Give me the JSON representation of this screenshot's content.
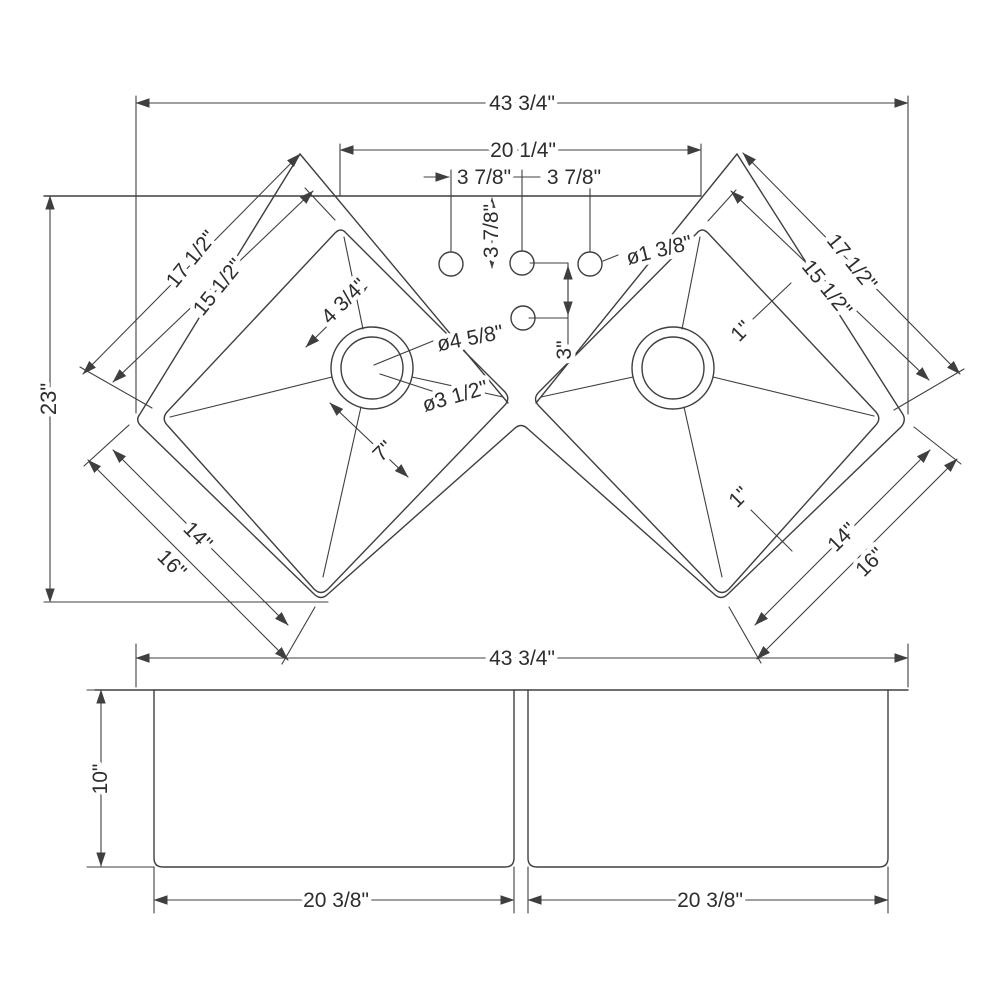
{
  "drawing_type": "corner double bowl sink dimension drawing",
  "plan": {
    "overall_width": "43 3/4\"",
    "bowl_span": "20 1/4\"",
    "depth": "23\"",
    "faucet_spacing_left": "3 7/8\"",
    "faucet_spacing_right": "3 7/8\"",
    "faucet_setback": "3 7/8\"",
    "faucet_drop": "3\"",
    "faucet_hole_dia": "ø1 3/8\"",
    "left": {
      "outer_edge": "17 1/2\"",
      "inner_edge": "15 1/2\"",
      "drain_diag": "4 3/4\"",
      "drain_outer_dia": "ø4 5/8\"",
      "drain_inner_dia": "ø3 1/2\"",
      "drain_front": "7\"",
      "bottom_inner": "14\"",
      "bottom_outer": "16\""
    },
    "right": {
      "outer_edge": "17 1/2\"",
      "inner_edge": "15 1/2\"",
      "flange_top": "1\"",
      "flange_bottom": "1\"",
      "bottom_inner": "14\"",
      "bottom_outer": "16\""
    }
  },
  "front": {
    "overall_width": "43 3/4\"",
    "bowl_depth": "10\"",
    "left_bowl_width": "20 3/8\"",
    "right_bowl_width": "20 3/8\""
  }
}
